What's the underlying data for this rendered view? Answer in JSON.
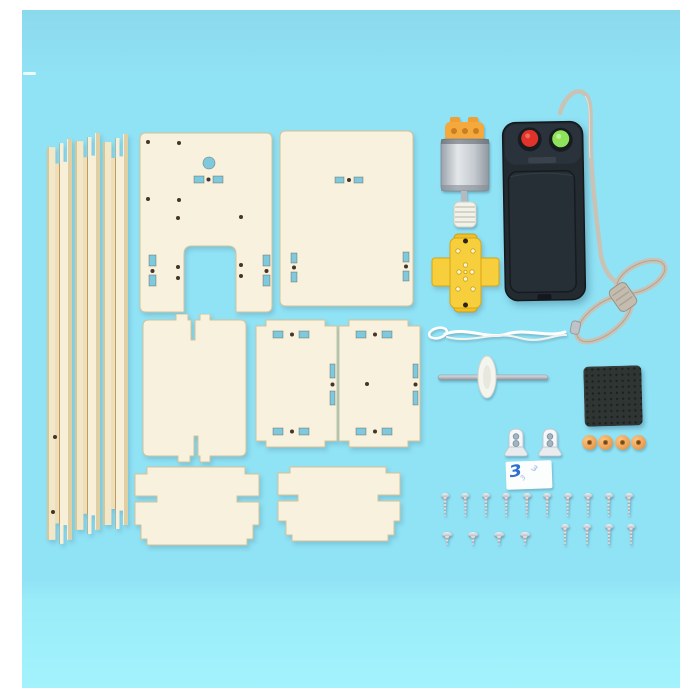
{
  "scene": {
    "description": "Flat-lay product photo of a DIY wooden elevator science-kit: laser-cut plywood rails and panels, DC motor with worm gear, two-button battery controller with coiled cord, yellow cross coupler, white string, steel axle with pulley disc, black foam pad, white axle brackets, adhesive sticker, orange pulley wheels and assorted screws on a light-blue backdrop."
  },
  "colors": {
    "bg_page": "#ffffff",
    "bg_top": "#8bd9ec",
    "bg_mid": "#90e2f5",
    "bg_low": "#99ecf8",
    "bg_bottom": "#a2f3fc",
    "wood": "#f7f1dd",
    "wood_edge": "#d6c396",
    "rail": "#f2e7c8",
    "slot": "#7fc9df",
    "dot": "#46352a",
    "motor_cap": "#f5a93c",
    "motor_body_light": "#e4e7ea",
    "motor_body_dark": "#9aa2aa",
    "worm": "#f3f2ea",
    "controller_body": "#232b31",
    "button_red": "#e0332a",
    "button_green": "#8fe35a",
    "cord": "#c9c2b5",
    "coupler": "#f7ce3b",
    "string": "#ffffff",
    "axle": "#c4c9cd",
    "pulley": "#f5f5f0",
    "foam": "#2f3533",
    "bracket": "#f5f6f8",
    "sticker": "#fcfdfd",
    "sticker_mark": "#2f6fd0",
    "wheel": "#eda55a",
    "screw": "#c3c8cd"
  },
  "parts": {
    "rails": {
      "label": "wooden guide rails",
      "count": 3
    },
    "panel_gantry": {
      "label": "top plate with U-shaped cutout"
    },
    "panel_back": {
      "label": "back plate with slots"
    },
    "panel_plain": {
      "label": "plain plate with tabs"
    },
    "panel_side_left": {
      "label": "side plate with slots"
    },
    "panel_side_right": {
      "label": "side plate with slots and center hole"
    },
    "panel_cabin_left": {
      "label": "cabin wall with notched edges"
    },
    "panel_cabin_right": {
      "label": "cabin wall with notched edges"
    },
    "motor": {
      "label": "DC motor with worm gear"
    },
    "controller": {
      "label": "handheld battery controller",
      "buttons": [
        {
          "name": "red"
        },
        {
          "name": "green"
        }
      ]
    },
    "cord": {
      "label": "controller cord coiled in a bundle"
    },
    "coupler": {
      "label": "yellow cross coupler"
    },
    "string": {
      "label": "white pull string with loop"
    },
    "axle": {
      "label": "steel axle with white pulley disc"
    },
    "foam_pad": {
      "label": "black foam pad"
    },
    "brackets": {
      "label": "white axle brackets",
      "count": 2
    },
    "sticker": {
      "label": "double-sided adhesive sticker",
      "mark": "3"
    },
    "wheels": {
      "label": "orange pulley wheels",
      "count": 4
    },
    "screws_long": {
      "label": "long screws",
      "count": 10
    },
    "screws_medium": {
      "label": "medium screws",
      "count": 4
    },
    "screws_flat": {
      "label": "flat-head screws",
      "count": 4
    }
  }
}
